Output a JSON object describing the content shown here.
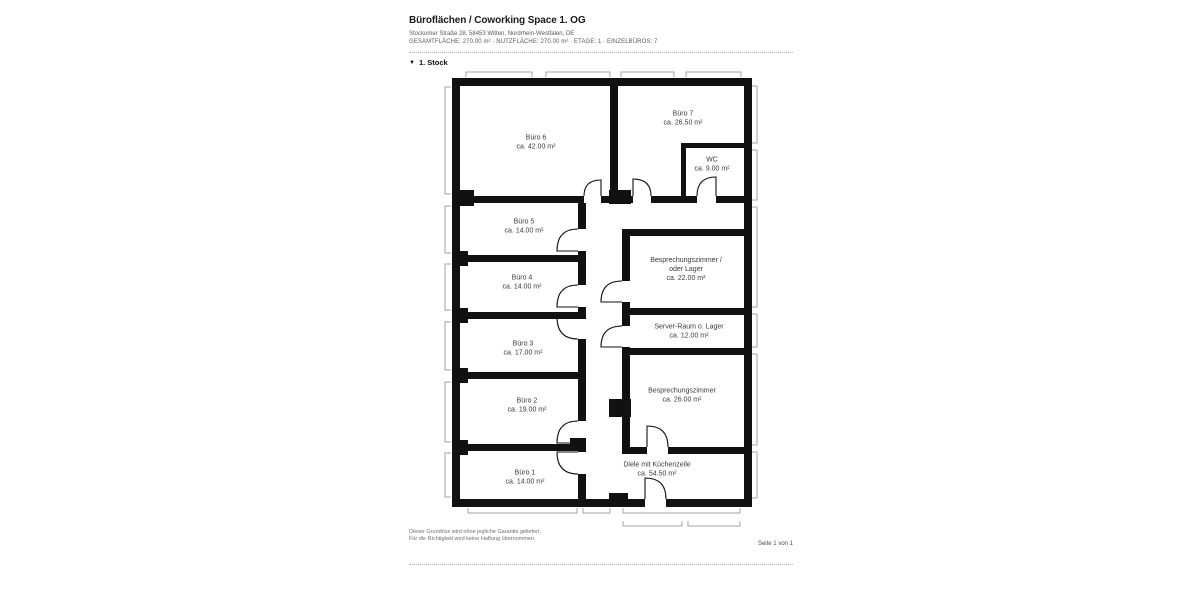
{
  "header": {
    "title": "Büroflächen / Coworking Space 1. OG",
    "address": "Stockumer Straße 28, 58453 Witten, Nordrhein-Westfalen, DE",
    "meta": "GESAMTFLÄCHE: 270.00 m² · NUTZFLÄCHE: 270.00 m² · ETAGE: 1 · EINZELBÜROS: 7"
  },
  "floor": {
    "toggle_icon": "▼",
    "label": "1. Stock"
  },
  "plan": {
    "rooms": [
      {
        "id": "buero-6",
        "name": "Büro 6",
        "area": "ca. 42.00 m²"
      },
      {
        "id": "buero-7",
        "name": "Büro 7",
        "area": "ca. 26.50 m²"
      },
      {
        "id": "wc",
        "name": "WC",
        "area": "ca. 9.00 m²"
      },
      {
        "id": "buero-5",
        "name": "Büro 5",
        "area": "ca. 14.00 m²"
      },
      {
        "id": "besprechungszimmer-oder-lager",
        "name": "Besprechungszimmer / oder Lager",
        "area": "ca. 22.00 m²"
      },
      {
        "id": "buero-4",
        "name": "Büro 4",
        "area": "ca. 14.00 m²"
      },
      {
        "id": "server-raum-o-lager",
        "name": "Server-Raum o. Lager",
        "area": "ca. 12.00 m²"
      },
      {
        "id": "buero-3",
        "name": "Büro 3",
        "area": "ca. 17.00 m²"
      },
      {
        "id": "besprechungszimmer",
        "name": "Besprechungszimmer",
        "area": "ca. 26.00 m²"
      },
      {
        "id": "buero-2",
        "name": "Büro 2",
        "area": "ca. 19.00 m²"
      },
      {
        "id": "buero-1",
        "name": "Büro 1",
        "area": "ca. 14.00 m²"
      },
      {
        "id": "diele-mit-kuechenzeile",
        "name": "Diele mit Küchenzeile",
        "area": "ca. 54.50 m²"
      }
    ]
  },
  "footer": {
    "disclaimer_line1": "Dieser Grundriss wird ohne jegliche Garantie geliefert.",
    "disclaimer_line2": "Für die Richtigkeit wird keine Haftung übernommen.",
    "page_indicator": "Seite 1 von 1"
  },
  "colors": {
    "wall": "#111111",
    "dimension_line": "#a3a3a3",
    "text_primary": "#1a1a1a",
    "text_secondary": "#5a5a5a"
  }
}
